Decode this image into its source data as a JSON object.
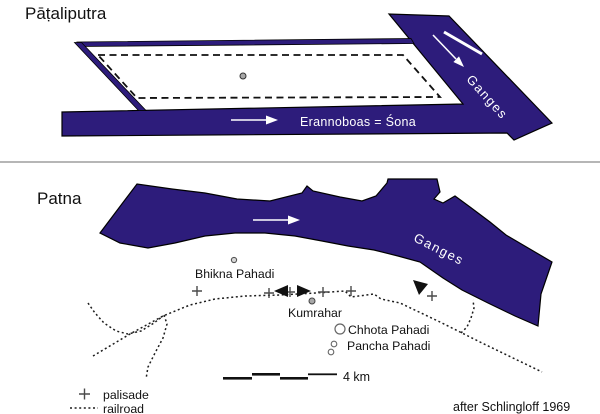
{
  "colors": {
    "river": "#2d1c7b",
    "outline": "#000000"
  },
  "upper_map": {
    "title": "Pāṭaliputra",
    "ganges_label": "Ganges",
    "erannoboas_label": "Erannoboas = Śona"
  },
  "lower_map": {
    "title": "Patna",
    "ganges_label": "Ganges",
    "sites": {
      "bhikna": "Bhikna Pahadi",
      "kumrahar": "Kumrahar",
      "chhota": "Chhota Pahadi",
      "pancha": "Pancha Pahadi"
    }
  },
  "legend": {
    "palisade": "palisade",
    "railroad": "railroad"
  },
  "scale_bar": {
    "label": "4 km"
  },
  "attribution": "after Schlingloff 1969"
}
